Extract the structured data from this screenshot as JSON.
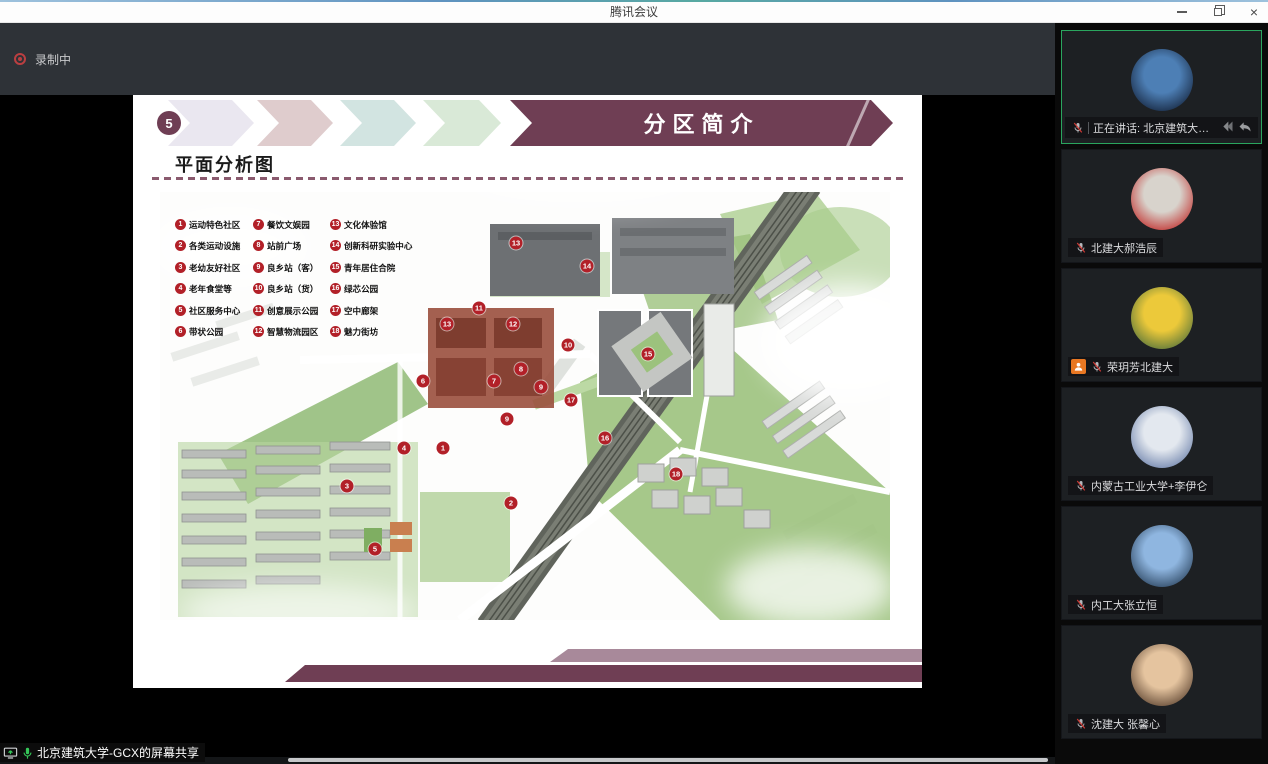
{
  "window": {
    "title": "腾讯会议",
    "controls": [
      {
        "icon": "minimize-icon"
      },
      {
        "icon": "restore-icon"
      },
      {
        "icon": "close-icon"
      }
    ]
  },
  "toolbar": {
    "recording_label": "录制中",
    "recording_icon": "record-dot-icon"
  },
  "theme": {
    "maroon": "#6f3e54",
    "marker_red": "#b22028",
    "active_green": "#2aa55e",
    "host_orange": "#e87722",
    "dash_line": "#8a5a6e",
    "chevron_colors": [
      "#eae7f0",
      "#dfcccd",
      "#d2e4e1",
      "#d9e9d7"
    ]
  },
  "slide": {
    "step_number": "5",
    "section_title": "分区简介",
    "heading": "平面分析图",
    "legend": {
      "columns": [
        [
          {
            "num": "1",
            "label": "运动特色社区"
          },
          {
            "num": "2",
            "label": "各类运动设施"
          },
          {
            "num": "3",
            "label": "老幼友好社区"
          },
          {
            "num": "4",
            "label": "老年食堂等"
          },
          {
            "num": "5",
            "label": "社区服务中心"
          },
          {
            "num": "6",
            "label": "带状公园"
          }
        ],
        [
          {
            "num": "7",
            "label": "餐饮文娱园"
          },
          {
            "num": "8",
            "label": "站前广场"
          },
          {
            "num": "9",
            "label": "良乡站（客）"
          },
          {
            "num": "10",
            "label": "良乡站（货）"
          },
          {
            "num": "11",
            "label": "创意展示公园"
          },
          {
            "num": "12",
            "label": "智慧物流园区"
          }
        ],
        [
          {
            "num": "13",
            "label": "文化体验馆"
          },
          {
            "num": "14",
            "label": "创新科研实验中心"
          },
          {
            "num": "15",
            "label": "青年居住合院"
          },
          {
            "num": "16",
            "label": "绿芯公园"
          },
          {
            "num": "17",
            "label": "空中廊架"
          },
          {
            "num": "18",
            "label": "魅力街坊"
          }
        ]
      ]
    },
    "map_markers": [
      {
        "n": "1",
        "x": 283,
        "y": 256
      },
      {
        "n": "2",
        "x": 351,
        "y": 311
      },
      {
        "n": "3",
        "x": 187,
        "y": 294
      },
      {
        "n": "4",
        "x": 244,
        "y": 256
      },
      {
        "n": "5",
        "x": 215,
        "y": 357
      },
      {
        "n": "6",
        "x": 263,
        "y": 189
      },
      {
        "n": "7",
        "x": 334,
        "y": 189
      },
      {
        "n": "8",
        "x": 361,
        "y": 177
      },
      {
        "n": "9",
        "x": 381,
        "y": 195
      },
      {
        "n": "9",
        "x": 347,
        "y": 227
      },
      {
        "n": "10",
        "x": 408,
        "y": 153
      },
      {
        "n": "11",
        "x": 319,
        "y": 116
      },
      {
        "n": "12",
        "x": 353,
        "y": 132
      },
      {
        "n": "13",
        "x": 356,
        "y": 51
      },
      {
        "n": "13",
        "x": 287,
        "y": 132
      },
      {
        "n": "14",
        "x": 427,
        "y": 74
      },
      {
        "n": "15",
        "x": 488,
        "y": 162
      },
      {
        "n": "16",
        "x": 445,
        "y": 246
      },
      {
        "n": "17",
        "x": 411,
        "y": 208
      },
      {
        "n": "18",
        "x": 516,
        "y": 282
      }
    ]
  },
  "sidebar": {
    "participants": [
      {
        "label": "正在讲话: 北京建筑大学-G...",
        "active": true,
        "muted": true,
        "host": false,
        "wide_caption": true,
        "caption_icons": [
          "collapse-arrow-icon",
          "reply-arrow-icon"
        ],
        "avatar_colors": [
          "#4d7fb5",
          "#16263f"
        ]
      },
      {
        "label": "北建大郝浩辰",
        "active": false,
        "muted": true,
        "host": false,
        "avatar_colors": [
          "#d8d3cc",
          "#c2312f"
        ]
      },
      {
        "label": "荣玥芳北建大",
        "active": false,
        "muted": true,
        "host": true,
        "avatar_colors": [
          "#ecc93a",
          "#56743b"
        ]
      },
      {
        "label": "内蒙古工业大学+李伊仑",
        "active": false,
        "muted": true,
        "host": false,
        "avatar_colors": [
          "#e3e8ef",
          "#6d82ab"
        ]
      },
      {
        "label": "内工大张立恒",
        "active": false,
        "muted": true,
        "host": false,
        "avatar_colors": [
          "#8fb6e0",
          "#2c4560"
        ]
      },
      {
        "label": "沈建大 张馨心",
        "active": false,
        "muted": true,
        "host": false,
        "avatar_colors": [
          "#e5c49f",
          "#5f4633"
        ]
      }
    ]
  },
  "share_bar": {
    "label": "北京建筑大学-GCX的屏幕共享",
    "icons": [
      "screen-share-icon",
      "mic-on-icon"
    ]
  }
}
